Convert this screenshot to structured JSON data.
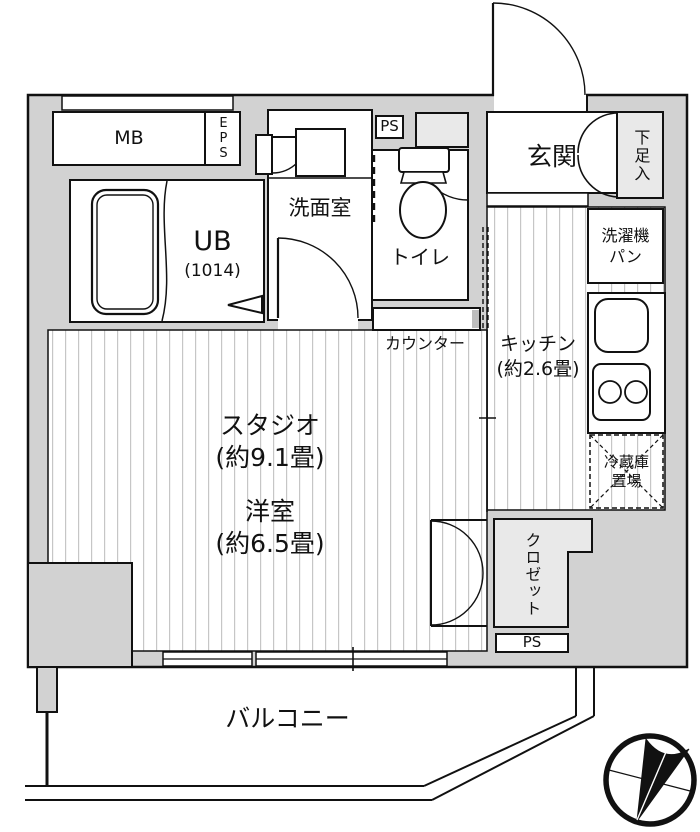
{
  "plan": {
    "title": "apartment-floor-plan",
    "colors": {
      "wall": "#d2d2d2",
      "room_light": "#e9e9e9",
      "line": "#111111",
      "stripe": "#c6c6c6",
      "counter_cap": "#bdbdbd"
    },
    "labels": {
      "mb": "MB",
      "eps": "EPS",
      "ub_name": "UB",
      "ub_size": "(1014)",
      "washroom": "洗面室",
      "ps_upper": "PS",
      "toilet": "トイレ",
      "entrance": "玄関",
      "shoe_box": "下足入",
      "laundry_pan": "洗濯機\nパン",
      "kitchen": "キッチン\n(約2.6畳)",
      "counter": "カウンター",
      "fridge_space": "冷蔵庫\n置場",
      "studio": "スタジオ\n(約9.1畳)",
      "western_room": "洋室\n(約6.5畳)",
      "closet": "クロゼット",
      "ps_lower": "PS",
      "balcony": "バルコニー"
    },
    "icons": {
      "compass": "north-arrow-icon",
      "bathtub": "bathtub-icon",
      "toilet": "toilet-icon",
      "sink": "sink-icon",
      "stove": "stove-icon"
    }
  }
}
